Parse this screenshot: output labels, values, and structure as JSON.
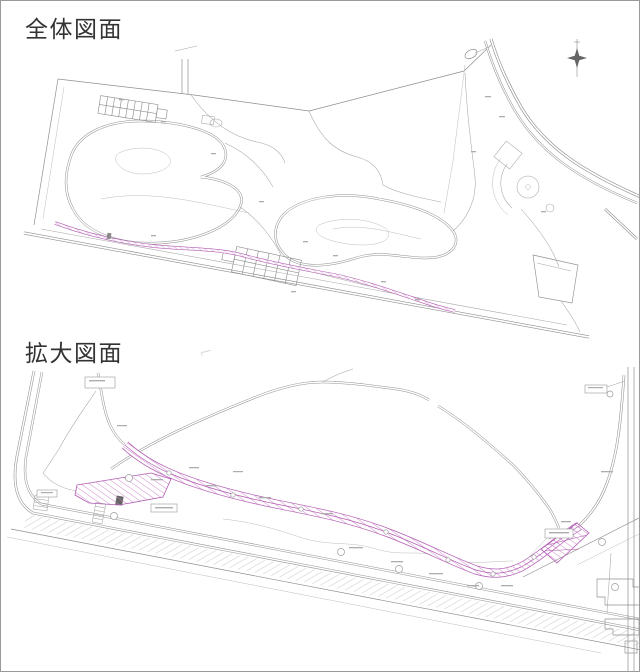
{
  "sections": {
    "overall": {
      "title": "全体図面"
    },
    "enlarged": {
      "title": "拡大図面"
    }
  },
  "drawing": {
    "background": "#ffffff",
    "frame_color": "#9a9a9a",
    "title_color": "#333333",
    "line_color": "#8f8f8f",
    "faint_line_color": "#bcbcbc",
    "highlight_color": "#b25cb2",
    "highlight_hatch_color": "#c77fc7"
  },
  "icons": {
    "north_arrow": "✦"
  }
}
